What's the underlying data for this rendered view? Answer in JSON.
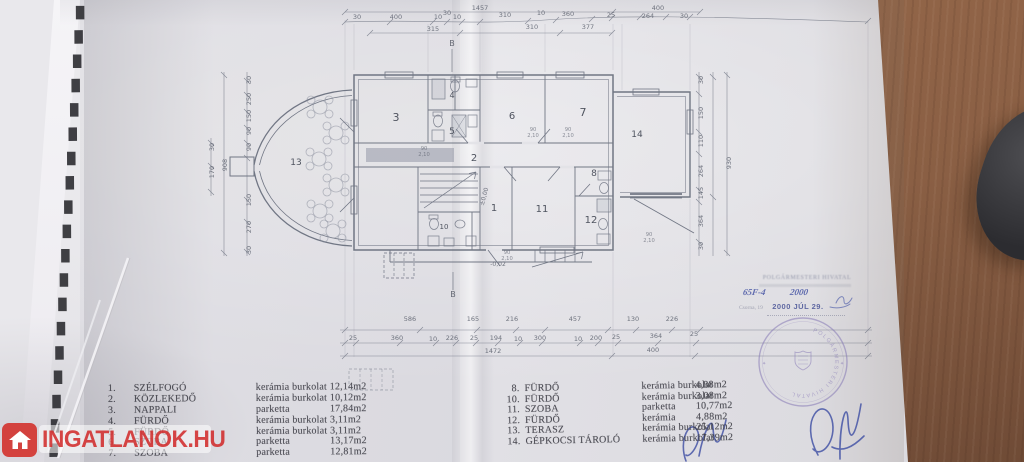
{
  "watermark": {
    "text": "INGATLANOK.HU",
    "icon": "house"
  },
  "legend": {
    "left": [
      {
        "num": "1.",
        "name": "SZÉLFOGÓ",
        "material": "kerámia burkolat",
        "area": "12,14m2"
      },
      {
        "num": "2.",
        "name": "KÖZLEKEDŐ",
        "material": "kerámia burkolat",
        "area": "10,12m2"
      },
      {
        "num": "3.",
        "name": "NAPPALI",
        "material": "parketta",
        "area": "17,84m2"
      },
      {
        "num": "4.",
        "name": "FÜRDŐ",
        "material": "kerámia burkolat",
        "area": "3,11m2"
      },
      {
        "num": "5.",
        "name": "FÜRDŐ",
        "material": "kerámia burkolat",
        "area": "3,11m2"
      },
      {
        "num": "6.",
        "name": "SZOBA",
        "material": "parketta",
        "area": "13,17m2"
      },
      {
        "num": "7.",
        "name": "SZOBA",
        "material": "parketta",
        "area": "12,81m2"
      }
    ],
    "right": [
      {
        "num": "8.",
        "name": "FÜRDŐ",
        "material": "kerámia burkolat",
        "area": "4,88m2"
      },
      {
        "num": "10.",
        "name": "FÜRDŐ",
        "material": "kerámia burkolat",
        "area": "3,08m2"
      },
      {
        "num": "11.",
        "name": "SZOBA",
        "material": "parketta",
        "area": "10,77m2"
      },
      {
        "num": "12.",
        "name": "FÜRDŐ",
        "material": "kerámia",
        "area": "4,88m2"
      },
      {
        "num": "13.",
        "name": "TERASZ",
        "material": "kerámia burkolat",
        "area": "25,12m2"
      },
      {
        "num": "14.",
        "name": "GÉPKOCSI TÁROLÓ",
        "material": "kerámia burkolat",
        "area": "17,39m2"
      }
    ]
  },
  "stamp": {
    "office": "POLGÁRMESTERI HIVATAL",
    "ref": "65F-4",
    "year": "2000",
    "city_line": "Csorna, 19",
    "date": "2000 JÚL 29."
  },
  "plan": {
    "rooms": [
      "3",
      "4",
      "5",
      "2",
      "6",
      "7",
      "14",
      "13",
      "1",
      "10",
      "11",
      "8",
      "12"
    ],
    "levels": {
      "zero": "±0,00",
      "minus": "-0,02"
    },
    "section": "B",
    "door_w": "90",
    "door_h": "2,10",
    "dims_top": [
      "30",
      "400",
      "10",
      "30",
      "10",
      "310",
      "10",
      "360",
      "25",
      "264",
      "30"
    ],
    "top_total": "1457",
    "top_right": "400",
    "dims_top2": [
      "315",
      "310",
      "377"
    ],
    "dims_bottom1": [
      "586",
      "165",
      "216",
      "457",
      "130",
      "226"
    ],
    "dims_bottom2": [
      "25",
      "360",
      "10",
      "226",
      "25",
      "194",
      "10",
      "300",
      "10",
      "200",
      "25",
      "364",
      "25"
    ],
    "dims_bottom3": [
      "1472",
      "400"
    ],
    "dims_left": [
      "30",
      "250",
      "150",
      "90",
      "90",
      "150",
      "270",
      "30"
    ],
    "left_total": "908",
    "left_small": [
      "30",
      "170"
    ],
    "dims_right": [
      "30",
      "150",
      "110",
      "264",
      "145",
      "364",
      "30"
    ],
    "right_total": "930"
  }
}
